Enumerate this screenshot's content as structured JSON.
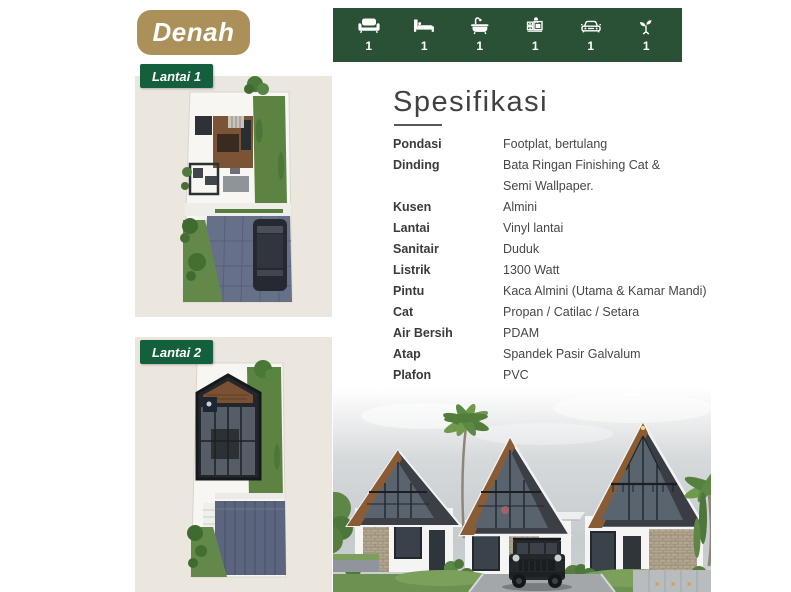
{
  "title_badge": {
    "label": "Denah",
    "bg": "#ab9159"
  },
  "amenities_bar": {
    "bg": "#2a5136",
    "items": [
      {
        "icon": "sofa-icon",
        "count": "1"
      },
      {
        "icon": "bed-icon",
        "count": "1"
      },
      {
        "icon": "bathtub-icon",
        "count": "1"
      },
      {
        "icon": "kitchen-icon",
        "count": "1"
      },
      {
        "icon": "car-icon",
        "count": "1"
      },
      {
        "icon": "plant-icon",
        "count": "1"
      }
    ]
  },
  "floor_plans": [
    {
      "label": "Lantai 1"
    },
    {
      "label": "Lantai 2"
    }
  ],
  "specs": {
    "heading": "Spesifikasi",
    "rows": [
      {
        "label": "Pondasi",
        "value": "Footplat, bertulang"
      },
      {
        "label": "Dinding",
        "value": "Bata Ringan Finishing Cat &",
        "value2": "Semi Wallpaper."
      },
      {
        "label": "Kusen",
        "value": "Almini"
      },
      {
        "label": "Lantai",
        "value": "Vinyl lantai"
      },
      {
        "label": "Sanitair",
        "value": "Duduk"
      },
      {
        "label": "Listrik",
        "value": "1300 Watt"
      },
      {
        "label": "Pintu",
        "value": "Kaca Almini (Utama & Kamar Mandi)"
      },
      {
        "label": "Cat",
        "value": "Propan / Catilac / Setara"
      },
      {
        "label": "Air Bersih",
        "value": "PDAM"
      },
      {
        "label": "Atap",
        "value": "Spandek Pasir Galvalum"
      },
      {
        "label": "Plafon",
        "value": "PVC"
      }
    ]
  },
  "colors": {
    "accent_green": "#2a5136",
    "badge_green": "#15603c",
    "gold": "#ab9159",
    "panel_beige": "#ebe7df"
  }
}
